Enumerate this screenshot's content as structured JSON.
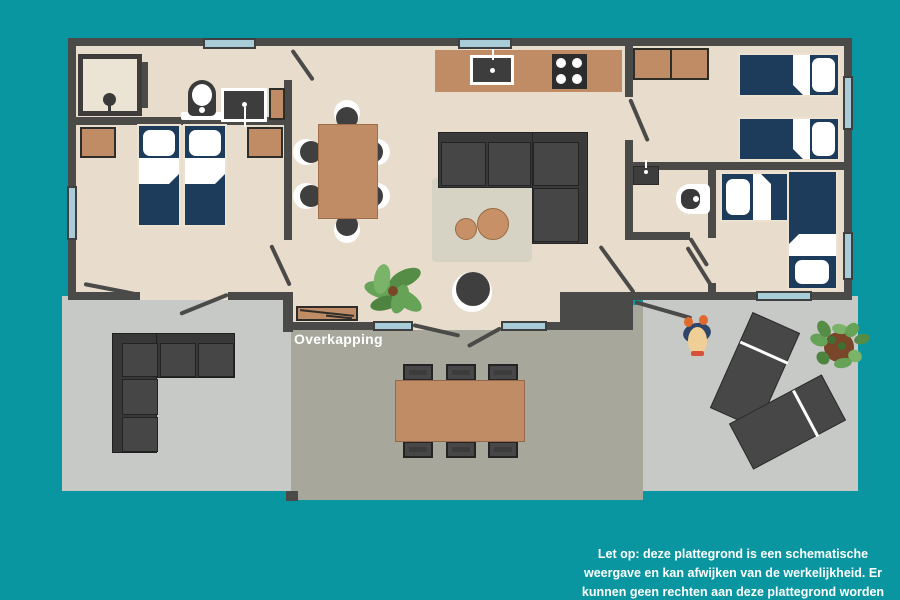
{
  "labels": {
    "overkapping": "Overkapping"
  },
  "disclaimer": {
    "line1": "Let op: deze plattegrond is een schematische",
    "line2": "weergave en kan afwijken van de werkelijkheid. Er",
    "line3": "kunnen geen rechten aan deze plattegrond worden"
  },
  "palette": {
    "teal": "#0a96a0",
    "wall": "#4a4a48",
    "floor": "#e8dccd",
    "terrace_light": "#c7c9c7",
    "terrace_mid": "#a7a89b",
    "wood": "#c08c66",
    "wood_light": "#c89066",
    "navy": "#1d3c5b",
    "window_blue": "#a9cdd8",
    "sofa_dark": "#3a3a3a",
    "rug": "#d6d2c4",
    "fixture_dark": "#3d3d3d",
    "plant_green": "#66a356",
    "pot_brown": "#7a4629",
    "skin": "#f0cf96",
    "body_blue": "#2e4469",
    "accent_orange": "#e06a2e",
    "accent_red": "#d6503c",
    "text_white": "#ffffff"
  }
}
